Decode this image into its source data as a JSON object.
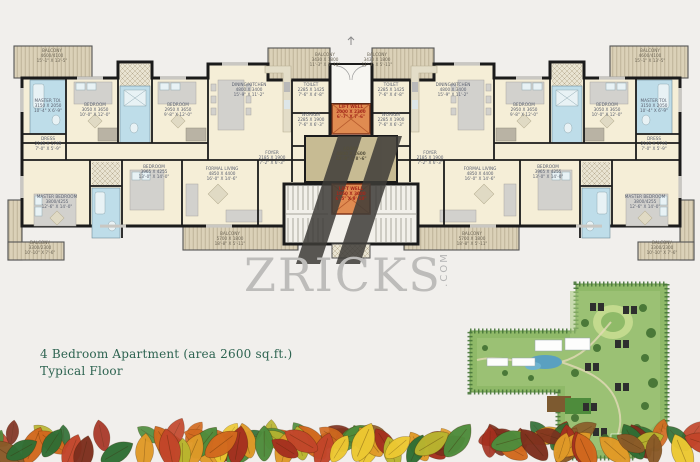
{
  "watermark": {
    "brand": "ZRICKS",
    "suffix": ".COM"
  },
  "caption": {
    "line1": "4 Bedroom Apartment (area 2600 sq.ft.)",
    "line2": "Typical Floor"
  },
  "rooms": {
    "balcony_tl": [
      "BALCONY",
      "4600/4100",
      "15'-1\" X 13'-5\""
    ],
    "master_toilet": [
      "MASTER TOI.",
      "3150 X 2050",
      "10'-4\" X 6'-9\""
    ],
    "dress": [
      "DRESS",
      "2145 X 1745",
      "7'-0\" X 5'-9\""
    ],
    "bedroom_a": [
      "BEDROOM",
      "3050 X 3650",
      "10'-0\" X 12'-0\""
    ],
    "bedroom_b": [
      "BEDROOM",
      "2950 X 3650",
      "9'-8\" X 12'-0\""
    ],
    "dining_kitchen": [
      "DINING/KITCHEN",
      "4800 X 3400",
      "15'-9\" X 11'-2\""
    ],
    "toilet": [
      "TOILET",
      "2285 X 1425",
      "7'-6\" X 4'-8\""
    ],
    "worker": [
      "WORKER",
      "2285 X 1900",
      "7'-6\" X 6'-3\""
    ],
    "foyer": [
      "FOYER",
      "2185 X 1900",
      "7'-2\" X 6'-3\""
    ],
    "balcony_tc": [
      "BALCONY",
      "3430 X 1800",
      "11'-3\" X 5'-11\""
    ],
    "lift_well_top": [
      "LIFT WELL",
      "2000 X 2300",
      "6'-7\" X 7'-6\""
    ],
    "lobby": [
      "LOBBY",
      "4800 X 2600",
      "15'-9\" X 8'-6\""
    ],
    "lift_well_bottom": [
      "LIFT WELL",
      "1950 X 3000",
      "6'-5\" X 9'-10\""
    ],
    "bedroom_c": [
      "BEDROOM",
      "3965 X 4255",
      "13'-0\" X 14'-0\""
    ],
    "formal_living": [
      "FORMAL LIVING",
      "4850 X 4400",
      "16'-0\" X 14'-6\""
    ],
    "master_bedroom": [
      "MASTER BEDROOM",
      "3800/4255",
      "12'-6\" X 14'-0\""
    ],
    "balcony_bl": [
      "BALCONY",
      "3300/2300",
      "10'-10\" X 7'-6\""
    ],
    "balcony_bc": [
      "BALCONY",
      "5700 X 1800",
      "18'-8\" X 5'-11\""
    ]
  },
  "colors": {
    "pageBg": "#f1efec",
    "planCream": "#f5eed7",
    "wall": "#1b1b1b",
    "balcony": "#dbd1b8",
    "balconyLine": "#b7ab90",
    "bath": "#bedde9",
    "bathFixture": "#e8f2f5",
    "lobby": "#c7bb93",
    "lift": "#e08b51",
    "liftText": "#a5281b",
    "labelText": "#5b6170",
    "balconyText": "#6e6757",
    "furniture": "#d2d1cd",
    "furnitureLine": "#a8a6a0",
    "window": "#c9c7c2",
    "logoDark": "#3e3c38",
    "watermarkGray": "#bdbcba",
    "captionGreen": "#2d6350",
    "siteBase": "#8fb968",
    "siteRing": "#47763a",
    "siteInner": "#a6c87d",
    "siteLawn": "#c3da8e",
    "sitePool": "#5aa0c0",
    "siteBuilding": "#fdfdfc",
    "leafPalette": [
      "#a5301f",
      "#c2452a",
      "#d2691e",
      "#e09a28",
      "#ecc832",
      "#b9b52f",
      "#2f6e34",
      "#4e8c3c",
      "#8a5a28",
      "#7e2f1e"
    ]
  }
}
